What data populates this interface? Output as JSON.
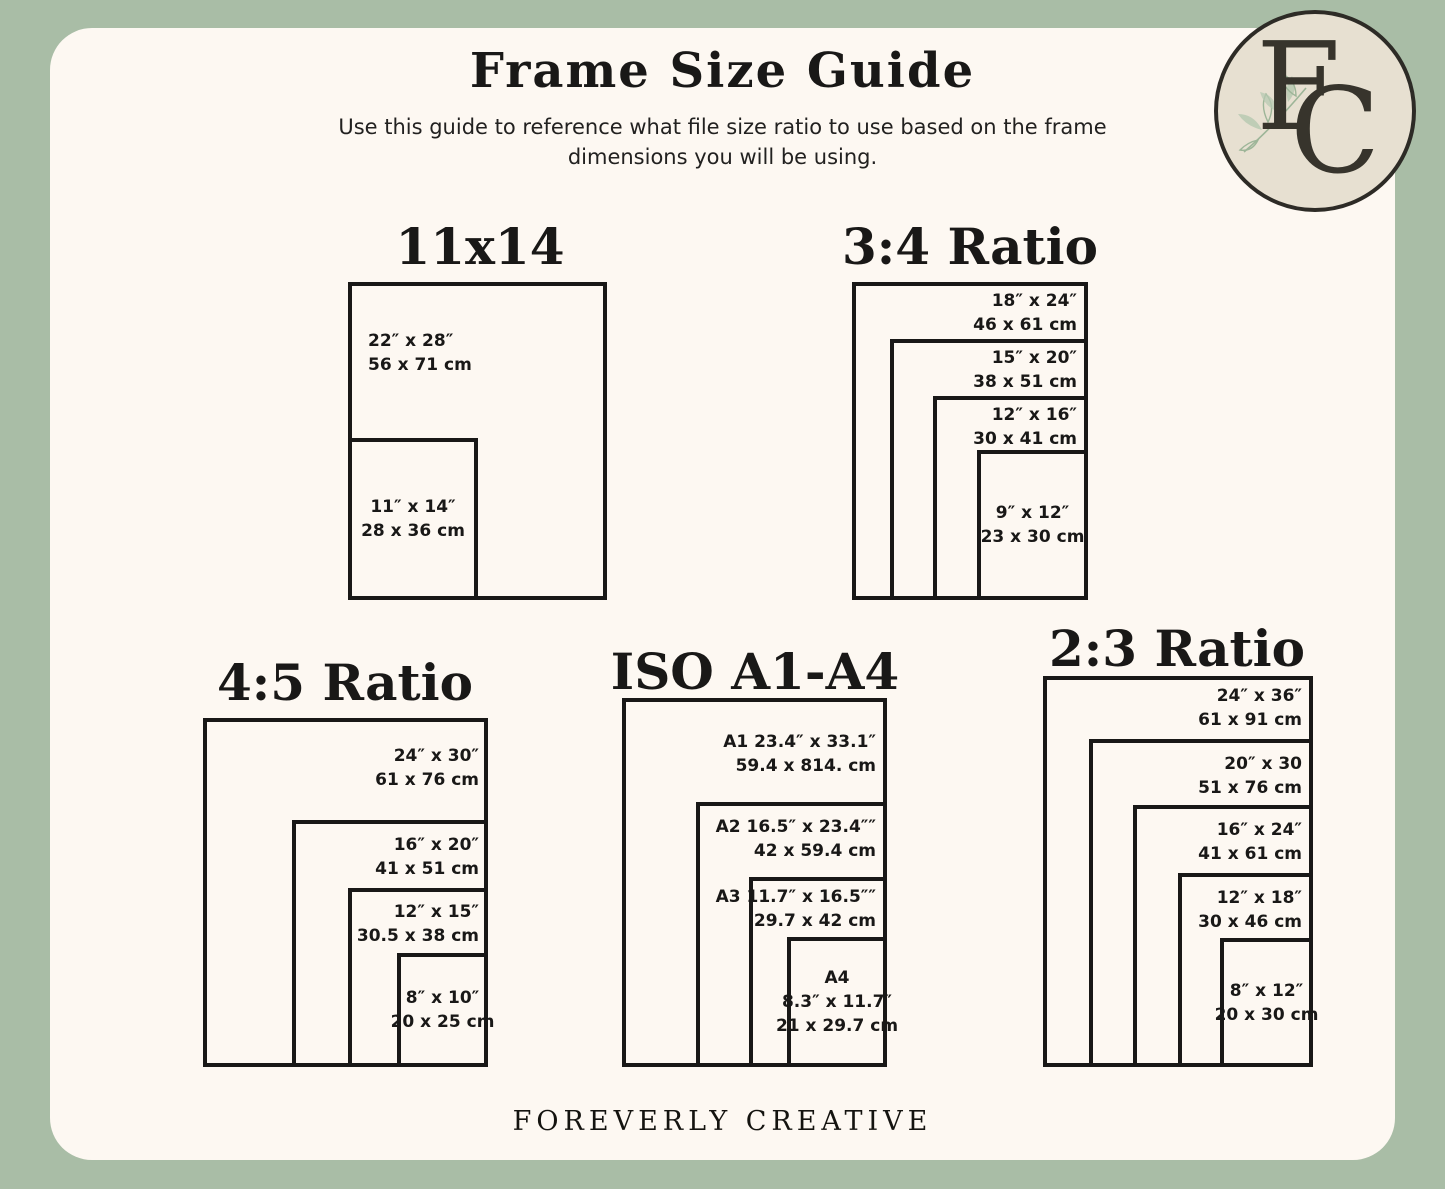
{
  "page": {
    "title": "Frame Size Guide",
    "subtitle_line1": "Use this guide to reference what file size ratio to use based on the frame",
    "subtitle_line2": "dimensions you will be using.",
    "footer": "FOREVERLY CREATIVE",
    "logo_letter_f": "F",
    "logo_letter_c": "C"
  },
  "colors": {
    "border_green": "#a9bda6",
    "panel_cream": "#fdf8f2",
    "ink": "#191817",
    "logo_bg": "#e7e0d1",
    "logo_ring": "#2d2b26",
    "logo_ink": "#37342c",
    "leaf_green": "#b7c9b1"
  },
  "diagrams": [
    {
      "id": "11x14",
      "title": "11x14",
      "title_cx": 480,
      "title_y": 219,
      "frames": [
        {
          "x": 348,
          "y": 282,
          "w": 259,
          "h": 318,
          "label": {
            "lines": [
              "22″ x 28″",
              "56 x 71 cm"
            ],
            "mode": "left",
            "x": 368,
            "y": 329
          }
        },
        {
          "x": 348,
          "y": 438,
          "w": 130,
          "h": 162,
          "label": {
            "lines": [
              "11″ x 14″",
              "28 x 36 cm"
            ],
            "mode": "center"
          }
        }
      ]
    },
    {
      "id": "3-4-ratio",
      "title": "3:4 Ratio",
      "title_cx": 970,
      "title_y": 219,
      "frames": [
        {
          "x": 852,
          "y": 282,
          "w": 236,
          "h": 318,
          "label": {
            "lines": [
              "18″ x 24″",
              "46 x 61 cm"
            ],
            "mode": "right",
            "x": 1077,
            "y": 289
          }
        },
        {
          "x": 890,
          "y": 339,
          "w": 198,
          "h": 261,
          "label": {
            "lines": [
              "15″ x 20″",
              "38 x 51 cm"
            ],
            "mode": "right",
            "x": 1077,
            "y": 346
          }
        },
        {
          "x": 933,
          "y": 396,
          "w": 155,
          "h": 204,
          "label": {
            "lines": [
              "12″ x 16″",
              "30 x 41 cm"
            ],
            "mode": "right",
            "x": 1077,
            "y": 403
          }
        },
        {
          "x": 977,
          "y": 450,
          "w": 111,
          "h": 150,
          "label": {
            "lines": [
              "9″ x 12″",
              "23 x 30 cm"
            ],
            "mode": "center"
          }
        }
      ]
    },
    {
      "id": "4-5-ratio",
      "title": "4:5 Ratio",
      "title_cx": 345,
      "title_y": 655,
      "frames": [
        {
          "x": 203,
          "y": 718,
          "w": 285,
          "h": 349,
          "label": {
            "lines": [
              "24″ x 30″",
              "61 x 76 cm"
            ],
            "mode": "right",
            "x": 479,
            "y": 744
          }
        },
        {
          "x": 292,
          "y": 820,
          "w": 196,
          "h": 247,
          "label": {
            "lines": [
              "16″ x 20″",
              "41 x 51 cm"
            ],
            "mode": "right",
            "x": 479,
            "y": 833
          }
        },
        {
          "x": 348,
          "y": 888,
          "w": 140,
          "h": 179,
          "label": {
            "lines": [
              "12″ x 15″",
              "30.5 x 38 cm"
            ],
            "mode": "right",
            "x": 479,
            "y": 900
          }
        },
        {
          "x": 397,
          "y": 953,
          "w": 91,
          "h": 114,
          "label": {
            "lines": [
              "8″ x 10″",
              "20 x 25 cm"
            ],
            "mode": "center"
          }
        }
      ]
    },
    {
      "id": "iso-a1-a4",
      "title": "ISO A1-A4",
      "title_cx": 755,
      "title_y": 644,
      "frames": [
        {
          "x": 622,
          "y": 698,
          "w": 265,
          "h": 369,
          "label": {
            "lines": [
              "A1 23.4″ x 33.1″",
              "59.4 x 814. cm"
            ],
            "mode": "right",
            "x": 876,
            "y": 730
          }
        },
        {
          "x": 696,
          "y": 802,
          "w": 191,
          "h": 265,
          "label": {
            "lines": [
              "A2 16.5″ x 23.4″″",
              "42 x 59.4 cm"
            ],
            "mode": "right",
            "x": 876,
            "y": 815
          }
        },
        {
          "x": 749,
          "y": 877,
          "w": 138,
          "h": 190,
          "label": {
            "lines": [
              "A3 11.7″ x 16.5″″",
              "29.7 x 42 cm"
            ],
            "mode": "right",
            "x": 876,
            "y": 885
          }
        },
        {
          "x": 787,
          "y": 937,
          "w": 100,
          "h": 130,
          "label": {
            "lines": [
              "A4",
              "8.3″ x 11.7″",
              "21 x 29.7 cm"
            ],
            "mode": "center"
          }
        }
      ]
    },
    {
      "id": "2-3-ratio",
      "title": "2:3 Ratio",
      "title_cx": 1177,
      "title_y": 621,
      "frames": [
        {
          "x": 1043,
          "y": 676,
          "w": 270,
          "h": 391,
          "label": {
            "lines": [
              "24″ x 36″",
              "61 x 91 cm"
            ],
            "mode": "right",
            "x": 1302,
            "y": 684
          }
        },
        {
          "x": 1089,
          "y": 739,
          "w": 224,
          "h": 328,
          "label": {
            "lines": [
              "20″ x 30",
              "51 x 76 cm"
            ],
            "mode": "right",
            "x": 1302,
            "y": 752
          }
        },
        {
          "x": 1133,
          "y": 805,
          "w": 180,
          "h": 262,
          "label": {
            "lines": [
              "16″ x 24″",
              "41 x 61 cm"
            ],
            "mode": "right",
            "x": 1302,
            "y": 818
          }
        },
        {
          "x": 1178,
          "y": 873,
          "w": 135,
          "h": 194,
          "label": {
            "lines": [
              "12″ x 18″",
              "30 x 46 cm"
            ],
            "mode": "right",
            "x": 1302,
            "y": 886
          }
        },
        {
          "x": 1220,
          "y": 938,
          "w": 93,
          "h": 129,
          "label": {
            "lines": [
              "8″ x 12″",
              "20 x 30 cm"
            ],
            "mode": "center"
          }
        }
      ]
    }
  ]
}
